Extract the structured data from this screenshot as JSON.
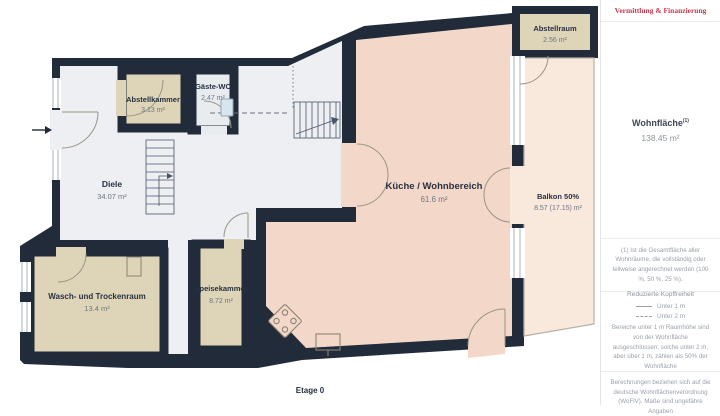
{
  "brand": {
    "title": "Vermittlung & Finanzierung",
    "color": "#c23a4e"
  },
  "sidebar": {
    "area_label": "Wohnfläche",
    "area_sup": "(1)",
    "area_value": "138.45 m²",
    "footnote": "(1) Ist die Gesamtfläche aller Wohnräume, die vollständig oder teilweise angerechnet werden (100 %, 50 %, 25 %).",
    "headroom_title": "Reduzierte Kopffreiheit",
    "legend": [
      {
        "style": "solid",
        "label": "Unter 1 m"
      },
      {
        "style": "dashed",
        "label": "Unter 2 m"
      }
    ],
    "headroom_note": "Bereiche unter 1 m Raumhöhe sind von der Wohnfläche ausgeschlossen; solche unter 2 m, aber über 1 m, zählen als 50% der Wohnfläche",
    "disclaimer": "Berechnungen beziehen sich auf die deutsche Wohnflächenverordnung (WoFlV). Maße sind ungefähre Angaben"
  },
  "floorplan": {
    "floor_label": "Etage 0",
    "rooms": {
      "abstellkammer": {
        "name": "Abstellkammer",
        "area": "3.13 m²"
      },
      "gaeste_wc": {
        "name": "Gäste-WC",
        "area": "2.47 m²"
      },
      "diele": {
        "name": "Diele",
        "area": "34.07 m²"
      },
      "wasch": {
        "name": "Wasch- und Trockenraum",
        "area": "13.4 m²"
      },
      "speisekammer": {
        "name": "Speisekammer",
        "area": "8.72 m²"
      },
      "kueche": {
        "name": "Küche / Wohnbereich",
        "area": "61.6 m²"
      },
      "abstellraum": {
        "name": "Abstellraum",
        "area": "2.56 m²"
      },
      "balkon": {
        "name": "Balkon 50%",
        "area": "8.57 (17.15) m²"
      }
    },
    "colors": {
      "wall": "#212b3a",
      "room_tan": "#ded4b8",
      "room_gray": "#edeff2",
      "room_wc": "#e8ecef",
      "kitchen": "#f3d8c9",
      "balcony": "#f9e8dc"
    }
  }
}
